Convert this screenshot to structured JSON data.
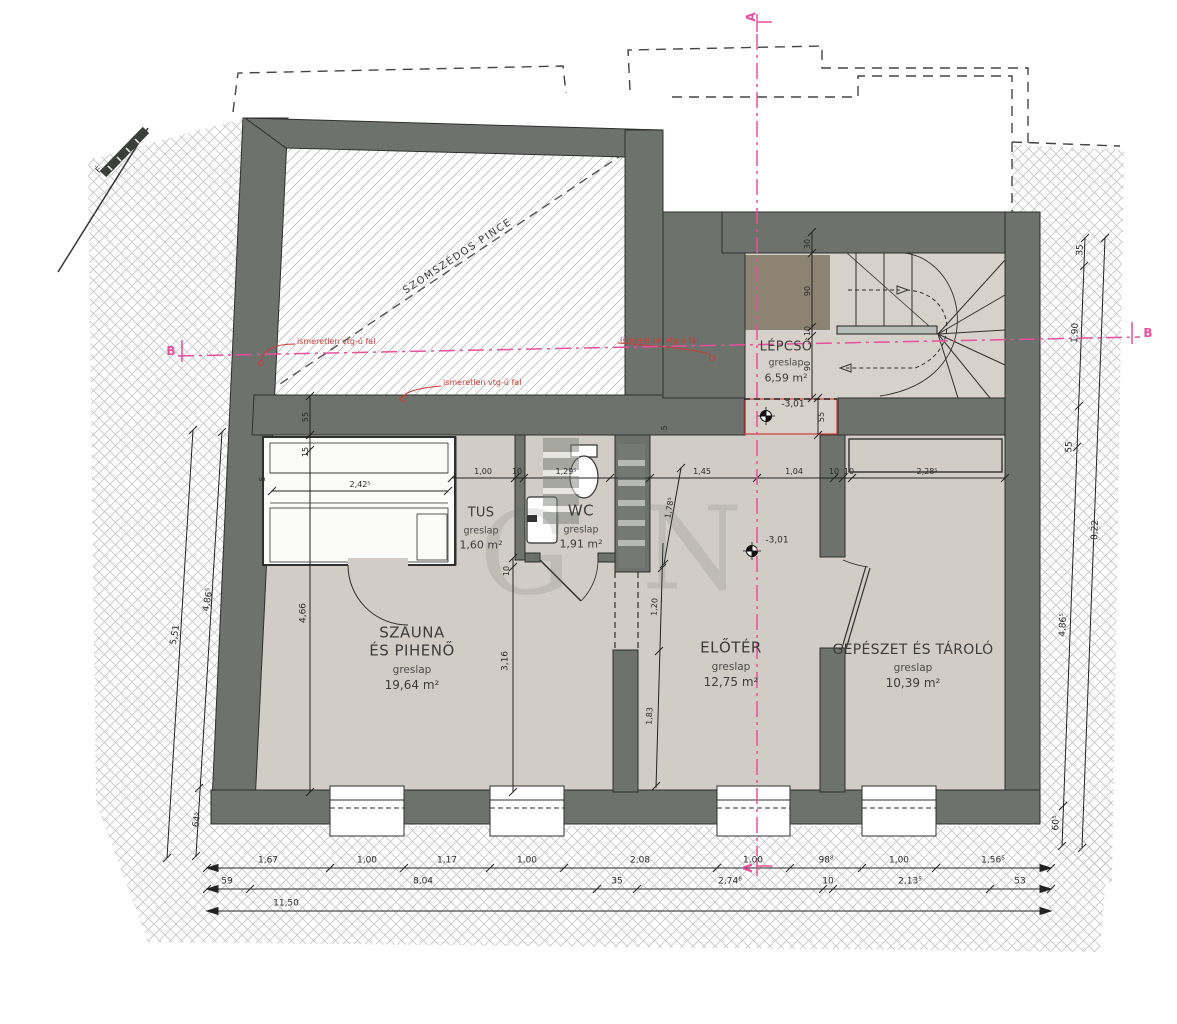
{
  "colors": {
    "wall": "#6e726d",
    "floor": "#d1cdc6",
    "stair_floor": "#d6d2cb",
    "landing": "#8d8373",
    "section_pink": "#e84f9e",
    "annotation_red": "#cc3b36",
    "hatch_gray": "#c6c6c6"
  },
  "compass": {
    "label": "É"
  },
  "watermark": {
    "letters": [
      "G",
      "N"
    ]
  },
  "sections": {
    "a": "A",
    "b": "B"
  },
  "annotations": {
    "neighbor_cellar": "SZOMSZÉDOS PINCE",
    "unknown_wall_1": "ismeretlen vtg-ú fal",
    "unknown_wall_2": "ismeretlen vtg-ú fal",
    "unknown_wall_3": "ismeretlen vtg-ú fal",
    "level_stair": "-3,01",
    "level_hall": "-3,01"
  },
  "rooms": {
    "szauna": {
      "name1": "SZAUNA",
      "name2": "ÉS  PIHENŐ",
      "finish": "greslap",
      "area": "19,64 m²"
    },
    "tus": {
      "name": "TUS",
      "finish": "greslap",
      "area": "1,60 m²"
    },
    "wc": {
      "name": "WC",
      "finish": "greslap",
      "area": "1,91 m²"
    },
    "eloter": {
      "name": "ELŐTÉR",
      "finish": "greslap",
      "area": "12,75 m²"
    },
    "gepeszet": {
      "name": "GÉPÉSZET ÉS TÁROLÓ",
      "finish": "greslap",
      "area": "10,39 m²"
    },
    "lepcso": {
      "name": "LÉPCSŐ",
      "finish": "greslap",
      "area": "6,59 m²"
    }
  },
  "dims": {
    "bottom_row1": [
      "1,67",
      "1,00",
      "1,17",
      "1,00",
      "2,08",
      "1,00",
      "98⁸",
      "1,00",
      "1,56⁵"
    ],
    "bottom_row2": [
      "59",
      "8,04",
      "35",
      "2,74⁸",
      "10",
      "2,13⁵",
      "53"
    ],
    "bottom_total": "11,50",
    "left": [
      "4,86⁵",
      "64⁵",
      "5,51"
    ],
    "right": [
      "35",
      "1,90",
      "55",
      "4,86⁵",
      "60⁵",
      "8,22"
    ],
    "top_interior": [
      "1,00",
      "10",
      "1,29⁵",
      "1,45",
      "1,04",
      "10",
      "10",
      "2,28⁵"
    ],
    "sauna_col": [
      "55",
      "15",
      "4,66"
    ],
    "sauna_bench": "2,42⁵",
    "sauna_left": "5",
    "mid_col": [
      "10",
      "3,16"
    ],
    "hall_col": [
      "1,78⁵",
      "1,20",
      "1,83"
    ],
    "hall_top": "5",
    "stair_col": [
      "30",
      "90",
      "10",
      "90"
    ],
    "stair_landing": "55"
  }
}
